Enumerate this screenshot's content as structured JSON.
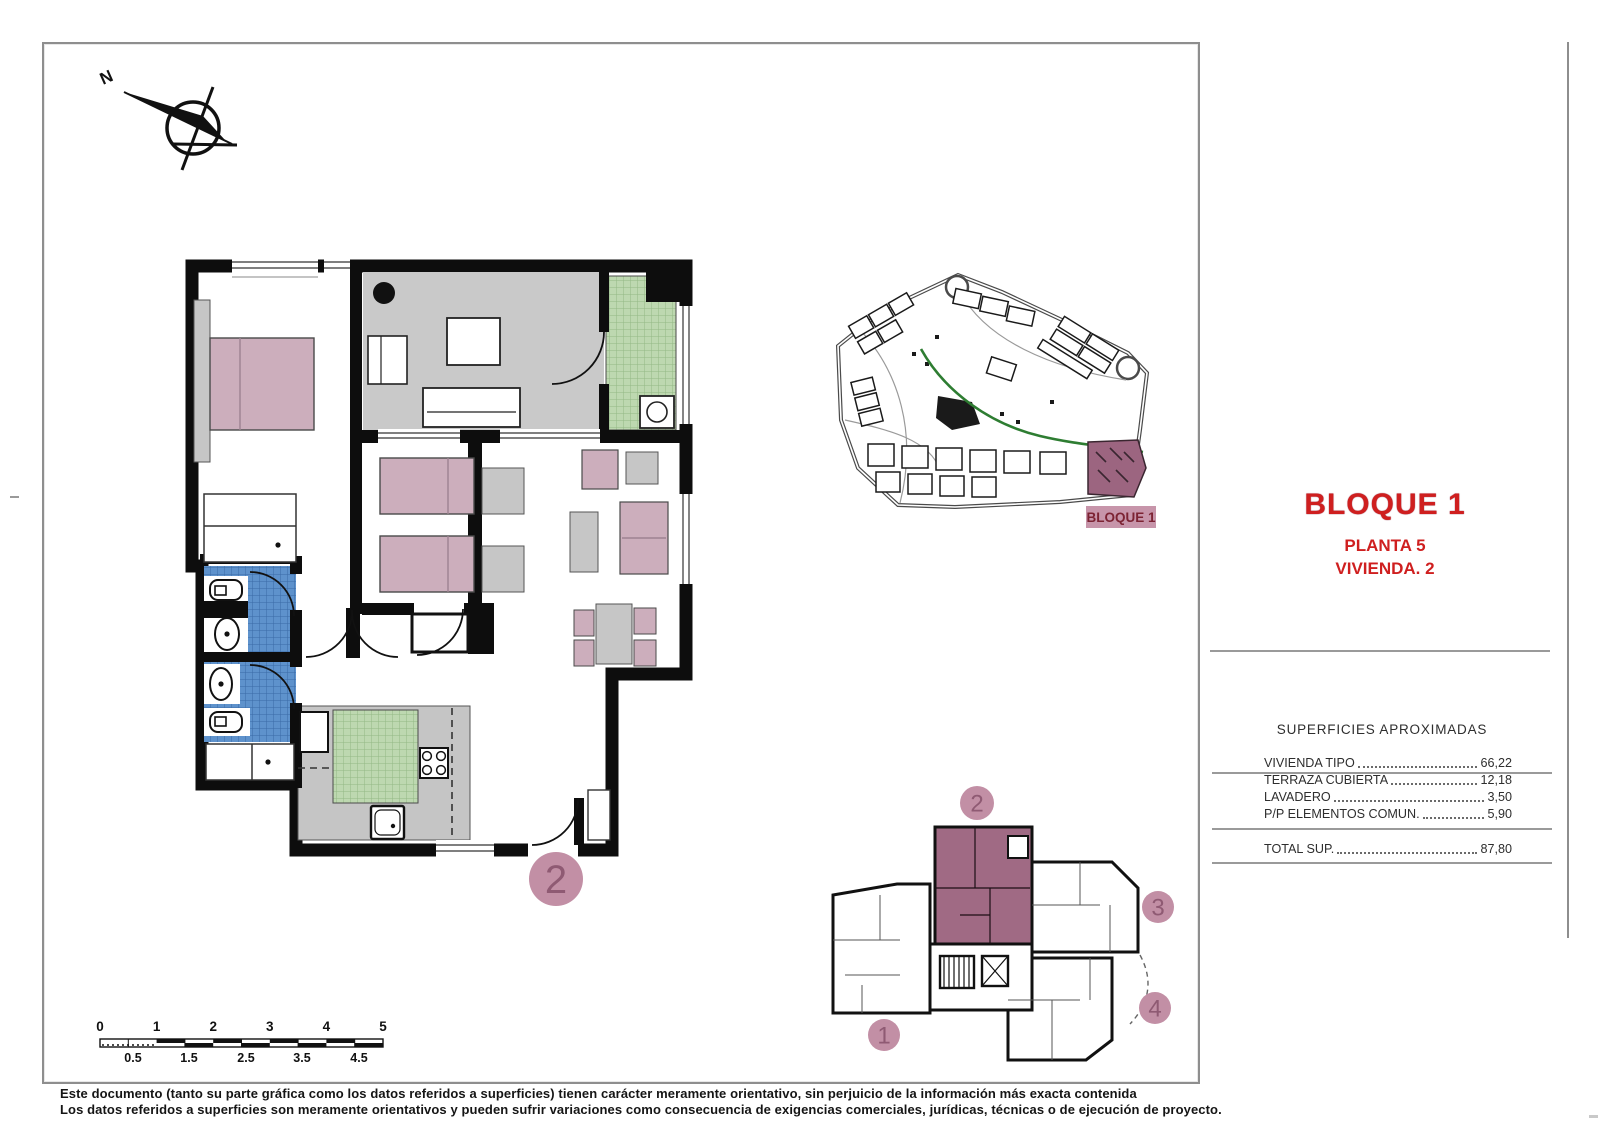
{
  "sheet": {
    "compass": {
      "label": "N"
    },
    "title_block": {
      "project": "BLOQUE 1",
      "floor": "PLANTA 5",
      "unit": "VIVIENDA. 2"
    },
    "site_plan": {
      "label": "BLOQUE 1"
    },
    "floor_plan": {
      "unit_badge": "2"
    },
    "key_plan": {
      "badge_1": "1",
      "badge_2": "2",
      "badge_3": "3",
      "badge_4": "4"
    },
    "areas_table": {
      "header": "SUPERFICIES APROXIMADAS",
      "rows": [
        {
          "label": "VIVIENDA TIPO",
          "value": "66,22"
        },
        {
          "label": "TERRAZA CUBIERTA",
          "value": "12,18"
        },
        {
          "label": "LAVADERO",
          "value": "3,50"
        },
        {
          "label": "P/P ELEMENTOS COMUN.",
          "value": "5,90"
        }
      ],
      "total_label": "TOTAL SUP.",
      "total_value": "87,80"
    },
    "scale_bar": {
      "top": [
        "0",
        "1",
        "2",
        "3",
        "4",
        "5"
      ],
      "bottom": [
        "0.5",
        "1.5",
        "2.5",
        "3.5",
        "4.5"
      ]
    },
    "disclaimer": {
      "line1": "Este documento (tanto su parte gráfica como los datos referidos a superficies) tienen carácter meramente orientativo, sin perjuicio de la información más exacta contenida",
      "line2": "Los datos referidos a superficies son meramente orientativos y pueden sufrir variaciones como consecuencia de exigencias comerciales, jurídicas, técnicas o de ejecución de proyecto."
    },
    "colors": {
      "accent_red": "#cf1f1f",
      "furniture_mauve": "#ccaebc",
      "badge_pink": "#c28fa5",
      "badge_glyph": "#8f5a73",
      "highlight_mauve": "#a06a84",
      "tile_blue": "#5e92cc",
      "tile_green": "#bdd8b0",
      "terrace_gray": "#c9c9c9",
      "path_green": "#2e7d32",
      "site_label_bg": "#c795aa",
      "site_label_text": "#7c2333"
    }
  }
}
